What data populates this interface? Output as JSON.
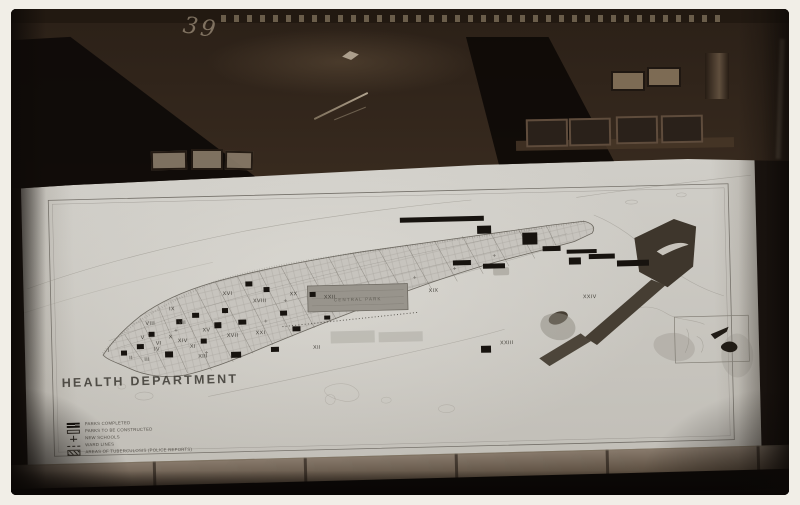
{
  "photo": {
    "handwritten_mark": "39",
    "map": {
      "title": "HEALTH DEPARTMENT",
      "central_park_label": "CENTRAL PARK",
      "legend": [
        {
          "symbol": "solid-bar",
          "label": "PARKS COMPLETED"
        },
        {
          "symbol": "open-bar",
          "label": "PARKS TO BE CONSTRUCTED"
        },
        {
          "symbol": "cross",
          "label": "NEW SCHOOLS"
        },
        {
          "symbol": "dash-line",
          "label": "WARD LINES"
        },
        {
          "symbol": "hatched-bar",
          "label": "AREAS OF TUBERCULOSIS (POLICE REPORTS)"
        }
      ],
      "wards": [
        {
          "n": "I",
          "x": 84,
          "y": 187
        },
        {
          "n": "II",
          "x": 106,
          "y": 195
        },
        {
          "n": "III",
          "x": 122,
          "y": 197
        },
        {
          "n": "IV",
          "x": 132,
          "y": 187
        },
        {
          "n": "V",
          "x": 118,
          "y": 175
        },
        {
          "n": "VI",
          "x": 134,
          "y": 181
        },
        {
          "n": "VII",
          "x": 158,
          "y": 161
        },
        {
          "n": "VIII",
          "x": 126,
          "y": 161
        },
        {
          "n": "IX",
          "x": 148,
          "y": 147
        },
        {
          "n": "X",
          "x": 146,
          "y": 175
        },
        {
          "n": "XI",
          "x": 168,
          "y": 185
        },
        {
          "n": "XII",
          "x": 292,
          "y": 189
        },
        {
          "n": "XIII",
          "x": 178,
          "y": 195
        },
        {
          "n": "XIV",
          "x": 158,
          "y": 179
        },
        {
          "n": "XV",
          "x": 182,
          "y": 169
        },
        {
          "n": "XVI",
          "x": 204,
          "y": 133
        },
        {
          "n": "XVII",
          "x": 208,
          "y": 175
        },
        {
          "n": "XVIII",
          "x": 236,
          "y": 141
        },
        {
          "n": "XIX",
          "x": 410,
          "y": 135
        },
        {
          "n": "XX",
          "x": 270,
          "y": 135
        },
        {
          "n": "XXI",
          "x": 236,
          "y": 173
        },
        {
          "n": "XXII",
          "x": 306,
          "y": 139
        },
        {
          "n": "XXIII",
          "x": 482,
          "y": 189
        },
        {
          "n": "XXIV",
          "x": 566,
          "y": 145
        }
      ],
      "parks_completed": [
        [
          96,
          186,
          6,
          5
        ],
        [
          112,
          180,
          7,
          5
        ],
        [
          124,
          168,
          6,
          5
        ],
        [
          140,
          188,
          8,
          6
        ],
        [
          152,
          156,
          6,
          5
        ],
        [
          168,
          150,
          7,
          5
        ],
        [
          176,
          176,
          6,
          5
        ],
        [
          190,
          160,
          7,
          6
        ],
        [
          198,
          146,
          6,
          5
        ],
        [
          214,
          158,
          8,
          5
        ],
        [
          222,
          120,
          7,
          5
        ],
        [
          240,
          126,
          6,
          5
        ],
        [
          256,
          150,
          7,
          5
        ],
        [
          268,
          166,
          8,
          5
        ],
        [
          286,
          132,
          6,
          5
        ],
        [
          300,
          156,
          6,
          4
        ],
        [
          206,
          190,
          10,
          6
        ],
        [
          246,
          186,
          8,
          5
        ],
        [
          378,
          60,
          84,
          5
        ],
        [
          500,
          78,
          15,
          12
        ],
        [
          520,
          92,
          18,
          5
        ],
        [
          544,
          96,
          30,
          4
        ],
        [
          566,
          101,
          26,
          5
        ],
        [
          594,
          108,
          32,
          6
        ],
        [
          546,
          104,
          12,
          7
        ],
        [
          455,
          70,
          14,
          8
        ],
        [
          460,
          108,
          22,
          5
        ],
        [
          430,
          104,
          18,
          5
        ],
        [
          456,
          190,
          10,
          7
        ]
      ]
    },
    "colors": {
      "paper": "#f1eee7",
      "plate": "#1c1511",
      "sheet": "#cccac4",
      "ink": "#46433d",
      "park_fill": "#17130f",
      "central_park": "#98948c",
      "annexed_park": "#3e362c",
      "gray_wash": "#8d8980"
    }
  }
}
